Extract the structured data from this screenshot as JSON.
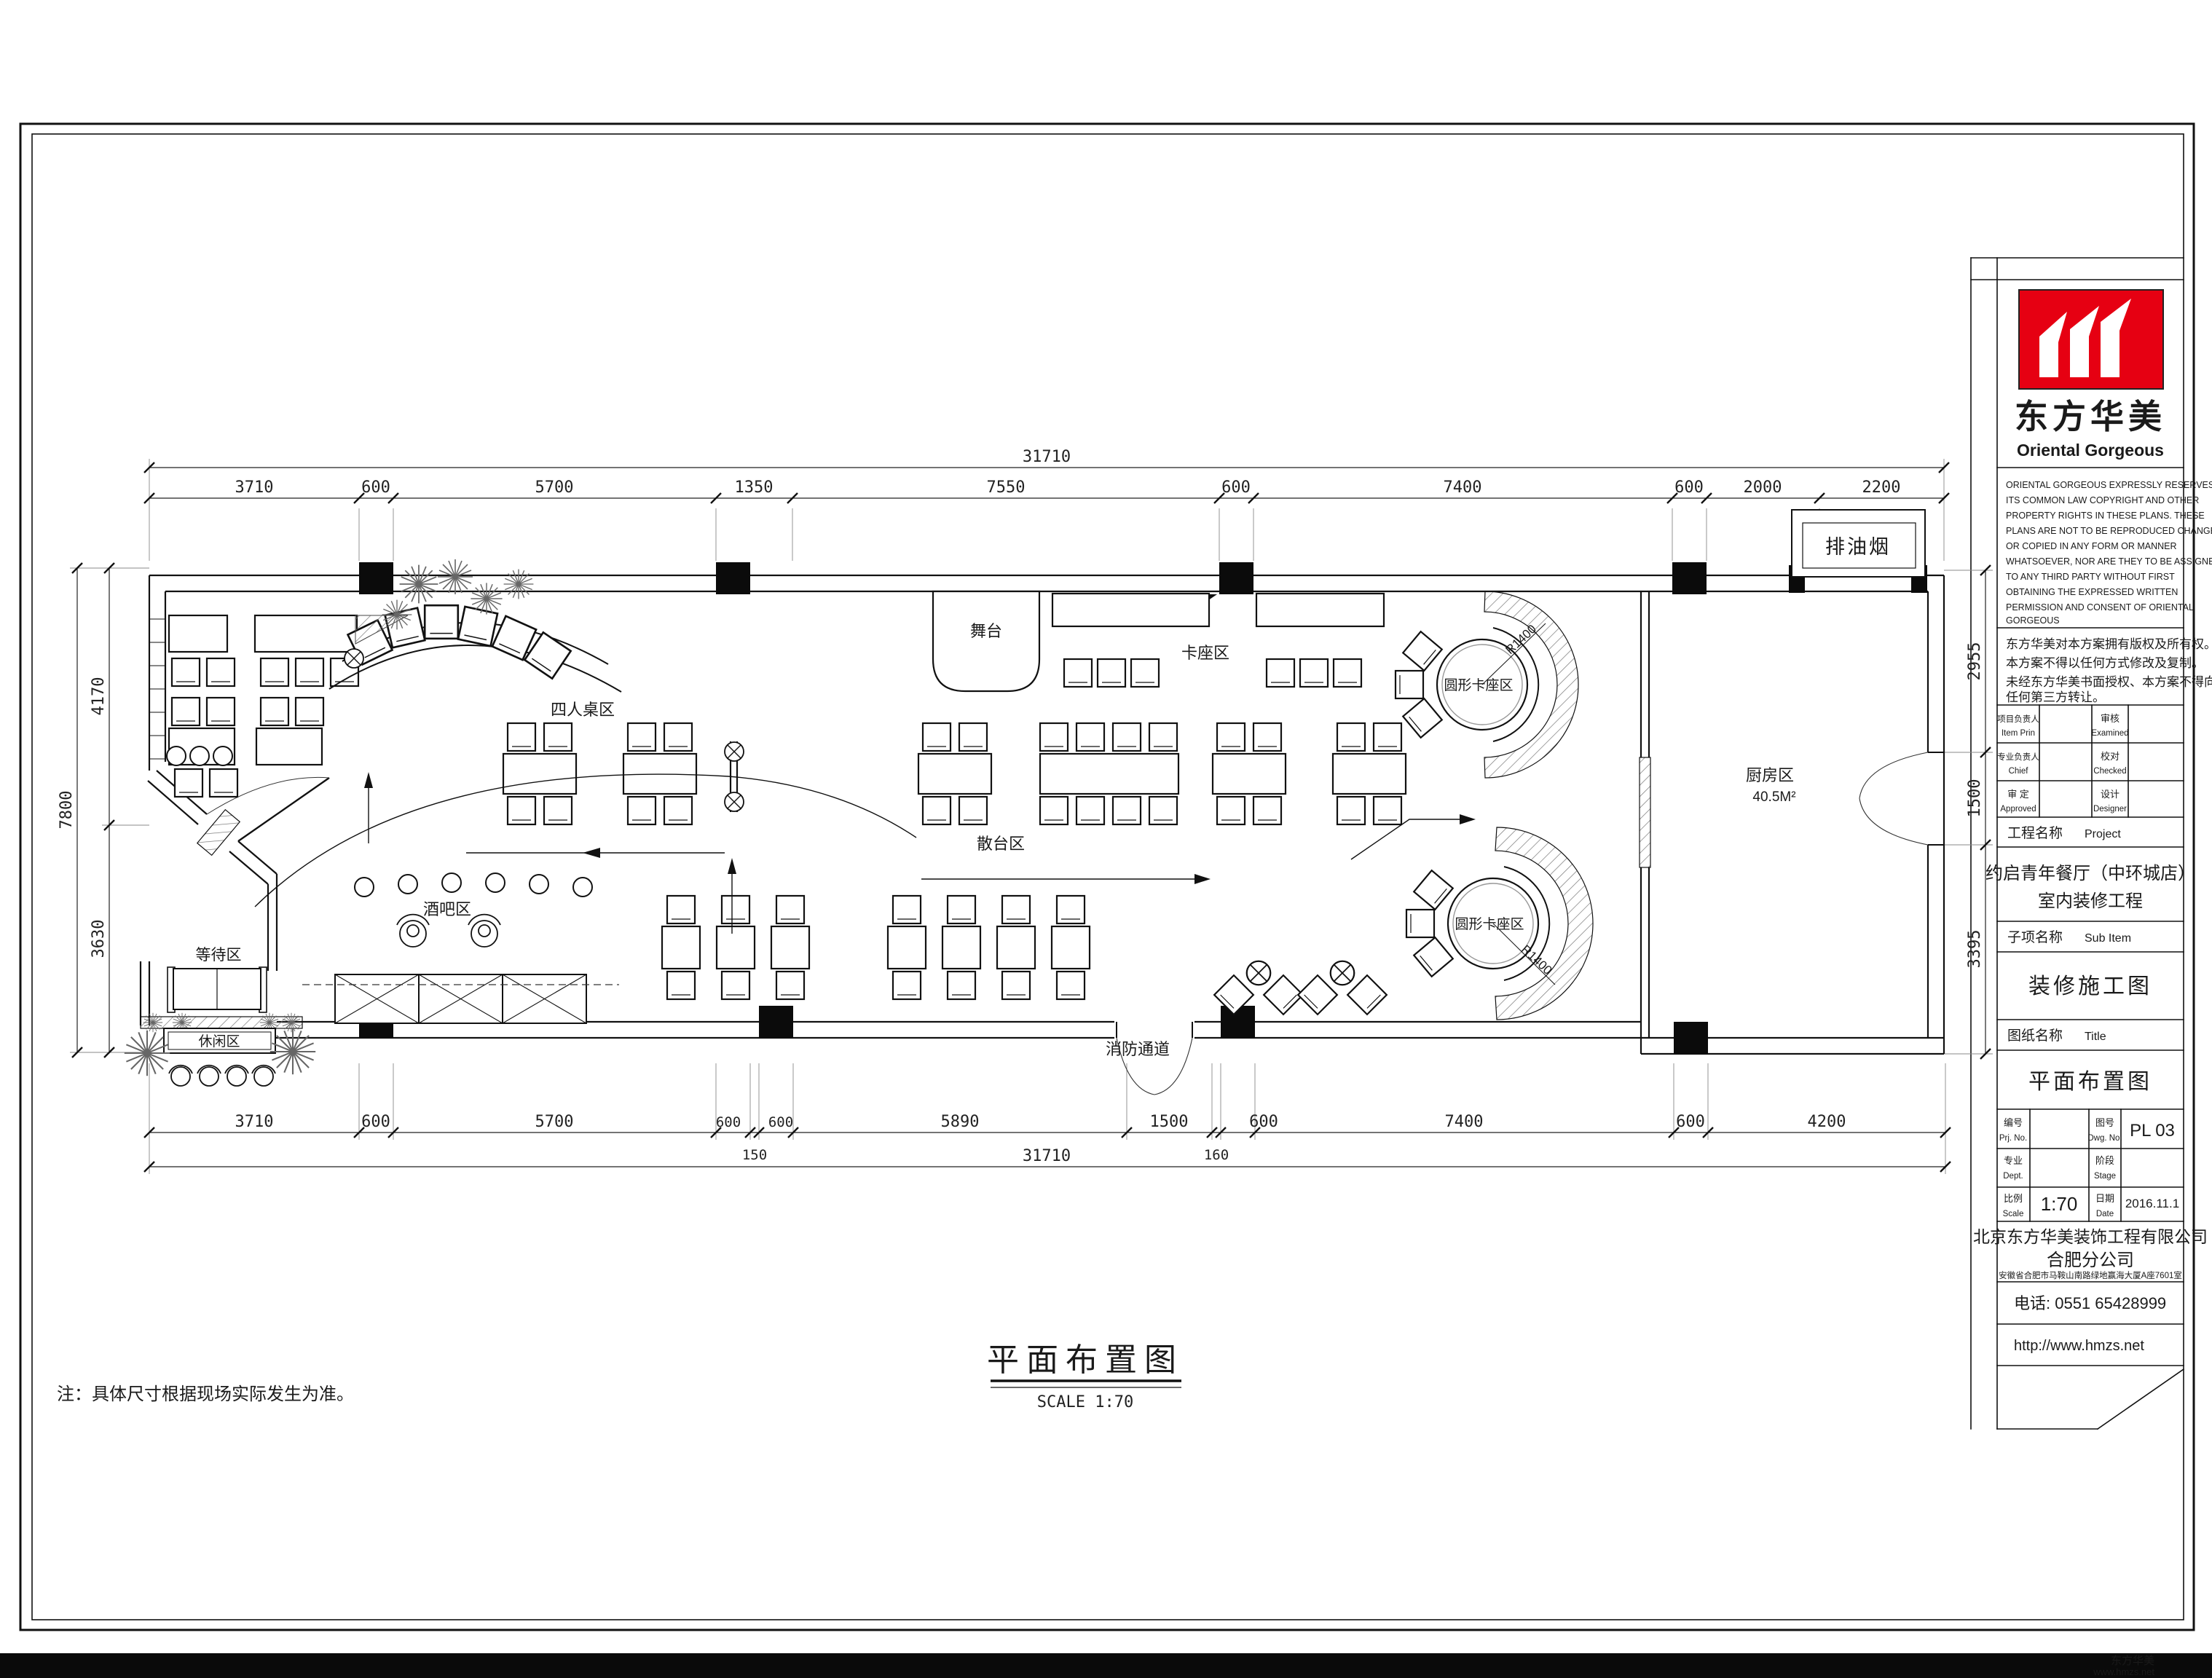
{
  "sheet": {
    "note": "注：具体尺寸根据现场实际发生为准。",
    "plan_title": "平面布置图",
    "plan_scale": "SCALE  1:70",
    "watermark_cn": "东方华美",
    "watermark_url": "www.hmzs.net"
  },
  "title_block": {
    "logo_cn": "东方华美",
    "logo_en": "Oriental  Gorgeous",
    "copyright_en": [
      "ORIENTAL GORGEOUS EXPRESSLY RESERVES",
      "ITS COMMON LAW COPYRIGHT AND OTHER",
      "PROPERTY RIGHTS IN THESE PLANS. THESE",
      "PLANS ARE NOT TO BE REPRODUCED CHANGED",
      "OR COPIED IN ANY FORM OR MANNER",
      "WHATSOEVER, NOR ARE THEY TO BE ASSIGNED",
      "TO ANY THIRD PARTY WITHOUT FIRST",
      "OBTAINING THE EXPRESSED WRITTEN",
      "PERMISSION AND CONSENT OF ORIENTAL",
      "GORGEOUS"
    ],
    "copyright_cn": [
      "东方华美对本方案拥有版权及所有权。",
      "本方案不得以任何方式修改及复制。",
      "未经东方华美书面授权、本方案不得向",
      "任何第三方转让。"
    ],
    "sign_rows": [
      {
        "l1": "项目负责人",
        "l2": "Item Prin",
        "r1": "审核",
        "r2": "Examined"
      },
      {
        "l1": "专业负责人",
        "l2": "Chief",
        "r1": "校对",
        "r2": "Checked"
      },
      {
        "l1": "审 定",
        "l2": "Approved",
        "r1": "设计",
        "r2": "Designer"
      }
    ],
    "project_label": "工程名称",
    "project_label_en": "Project",
    "project_name1": "约启青年餐厅（中环城店）",
    "project_name2": "室内装修工程",
    "subitem_label": "子项名称",
    "subitem_label_en": "Sub Item",
    "subitem_value": "装修施工图",
    "sheetname_label": "图纸名称",
    "sheetname_label_en": "Title",
    "sheetname_value": "平面布置图",
    "prjno_label": "编号",
    "prjno_label_en": "Prj. No.",
    "dwgno_label": "图号",
    "dwgno_label_en": "Dwg. No.",
    "dwgno_value": "PL 03",
    "dept_label": "专业",
    "dept_label_en": "Dept.",
    "stage_label": "阶段",
    "stage_label_en": "Stage",
    "scale_label": "比例",
    "scale_label_en": "Scale",
    "scale_value": "1:70",
    "date_label": "日期",
    "date_label_en": "Date",
    "date_value": "2016.11.1",
    "company1": "北京东方华美装饰工程有限公司",
    "company2": "合肥分公司",
    "company_addr": "安徽省合肥市马鞍山南路绿地赢海大厦A座7601室",
    "phone": "电话: 0551 65428999",
    "website": "http://www.hmzs.net",
    "accent_color": "#e60012"
  },
  "plan": {
    "labels": {
      "stage": "舞台",
      "booth": "卡座区",
      "four": "四人桌区",
      "scatter": "散台区",
      "round": "圆形卡座区",
      "kitchen": "厨房区",
      "kitchen_area": "40.5M²",
      "bar": "酒吧区",
      "waiting": "等待区",
      "leisure": "休闲区",
      "fire": "消防通道",
      "fume": "排油烟",
      "radius": "R1400"
    },
    "dims": {
      "top_overall": "31710",
      "top": [
        "3710",
        "600",
        "5700",
        "1350",
        "7550",
        "600",
        "7400",
        "600",
        "2000",
        "2200"
      ],
      "bottom": [
        "3710",
        "600",
        "5700",
        "600",
        "150",
        "600",
        "5890",
        "1500",
        "160",
        "600",
        "7400",
        "600",
        "4200"
      ],
      "bottom_overall": "31710",
      "left": [
        "4170",
        "3630"
      ],
      "left_overall": "7800",
      "right": [
        "2955",
        "1500",
        "3395"
      ]
    }
  }
}
